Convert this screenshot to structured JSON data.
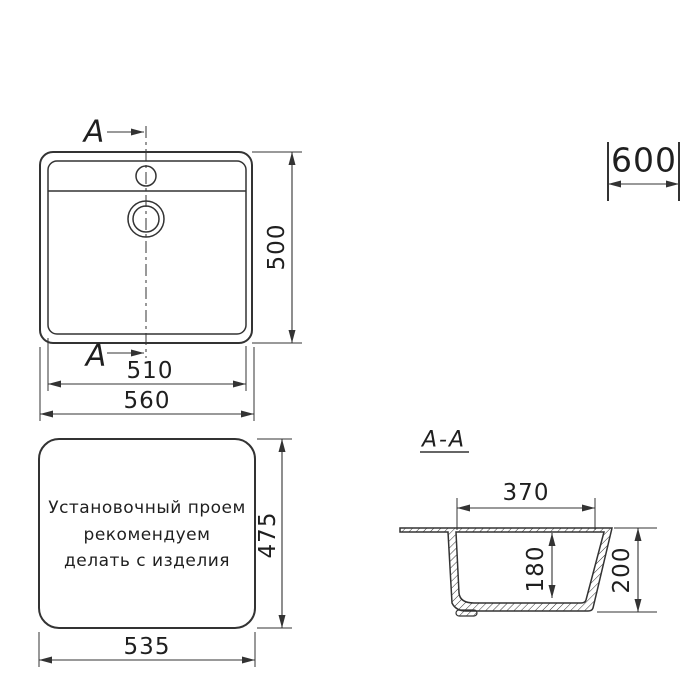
{
  "colors": {
    "line": "#333333",
    "text": "#1f1f1f",
    "background": "#ffffff"
  },
  "plan_view": {
    "section_label": "A",
    "dims": {
      "height": "500",
      "inner_width": "510",
      "outer_width": "560"
    }
  },
  "cabinet": {
    "width": "600"
  },
  "opening_view": {
    "note": [
      "Установочный проем",
      "рекомендуем",
      "делать с изделия"
    ],
    "dims": {
      "height": "475",
      "width": "535"
    }
  },
  "section_view": {
    "title": "A-A",
    "dims": {
      "top_width": "370",
      "inner_depth": "180",
      "outer_depth": "200"
    }
  }
}
